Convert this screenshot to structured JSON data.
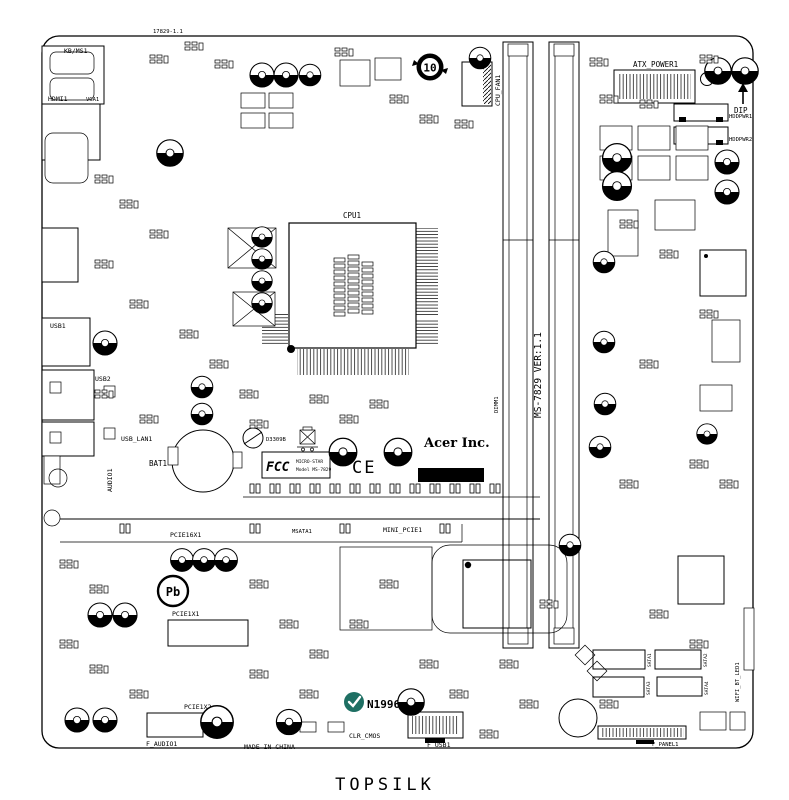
{
  "title": {
    "topsilk": "TOPSILK"
  },
  "board": {
    "code": "17829-1.1",
    "version_vertical": "MS-7829 VER:1.1",
    "made_in": "MADE IN CHINA"
  },
  "branding": {
    "acer": "Acer Inc.",
    "n1996": "N1996",
    "fcc_logo": "FCC",
    "fcc_line1": "MICRO-STAR",
    "fcc_line2": "Model MS-7829",
    "ce": "CE",
    "d_code": "D3309B",
    "pb_free": "Pb",
    "recycle_mark": "10"
  },
  "connectors": {
    "kb_ms1": "KB/MS1",
    "hdmi1": "HDMI1",
    "vga1": "VGA1",
    "usb1": "USB1",
    "usb2": "USB2",
    "usb_lan1": "USB_LAN1",
    "audio1": "AUDIO1",
    "bat1": "BAT1",
    "cpu1": "CPU1",
    "cpu_fan1": "CPU_FAN1",
    "atx_power1": "ATX_POWER1",
    "dip": "DIP",
    "hddpwr1": "HDDPWR1",
    "hddpwr2": "HDDPWR2",
    "dimm1": "DIMM1",
    "pcie16x1": "PCIE16X1",
    "msata1": "MSATA1",
    "mini_pcie1": "MINI_PCIE1",
    "pcie1x1": "PCIE1X1",
    "pcie1x2": "PCIE1X2",
    "f_audio1": "F_AUDIO1",
    "clr_cmos": "CLR_CMOS",
    "f_usb1": "F_USB1",
    "f_panel1": "F_PANEL1",
    "sata1": "SATA1",
    "sata2": "SATA2",
    "sata3": "SATA3",
    "sata4": "SATA4",
    "wifi_bt_led1": "WIFI_BT_LED1"
  },
  "colors": {
    "silkscreen": "#000000",
    "background": "#ffffff",
    "n1996_badge": "#1e6f63"
  }
}
